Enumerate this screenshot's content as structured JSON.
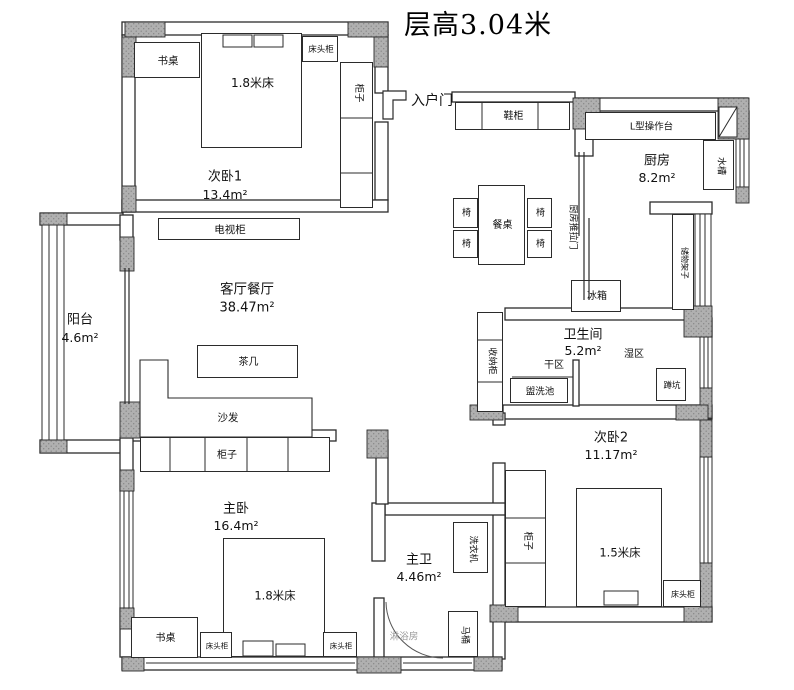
{
  "title": "层高3.04米",
  "rooms": [
    {
      "id": "ciwo1",
      "name": "次卧1",
      "area": "13.4m²"
    },
    {
      "id": "keting",
      "name": "客厅餐厅",
      "area": "38.47m²"
    },
    {
      "id": "yangtai",
      "name": "阳台",
      "area": "4.6m²"
    },
    {
      "id": "chufang",
      "name": "厨房",
      "area": "8.2m²"
    },
    {
      "id": "weishengjian",
      "name": "卫生间",
      "area": "5.2m²"
    },
    {
      "id": "ciwo2",
      "name": "次卧2",
      "area": "11.17m²"
    },
    {
      "id": "zhuwo",
      "name": "主卧",
      "area": "16.4m²"
    },
    {
      "id": "zhuwei",
      "name": "主卫",
      "area": "4.46m²"
    }
  ],
  "furniture": [
    {
      "id": "desk1",
      "label": "书桌"
    },
    {
      "id": "bed1",
      "label": "1.8米床"
    },
    {
      "id": "nightstand1",
      "label": "床头柜"
    },
    {
      "id": "wardrobe1",
      "label": "柜子"
    },
    {
      "id": "tv-cabinet",
      "label": "电视柜"
    },
    {
      "id": "shoe-cabinet",
      "label": "鞋柜"
    },
    {
      "id": "counter",
      "label": "L型操作台"
    },
    {
      "id": "sink",
      "label": "水槽"
    },
    {
      "id": "fridge",
      "label": "冰箱"
    },
    {
      "id": "dining-table",
      "label": "餐桌"
    },
    {
      "id": "chair1",
      "label": "椅"
    },
    {
      "id": "chair2",
      "label": "椅"
    },
    {
      "id": "chair3",
      "label": "椅"
    },
    {
      "id": "chair4",
      "label": "椅"
    },
    {
      "id": "tea-table",
      "label": "茶几"
    },
    {
      "id": "storage-cabinet",
      "label": "收纳柜"
    },
    {
      "id": "washbasin",
      "label": "盥洗池"
    },
    {
      "id": "squat-toilet",
      "label": "蹲坑"
    },
    {
      "id": "wardrobe2",
      "label": "柜子"
    },
    {
      "id": "bed2",
      "label": "1.5米床"
    },
    {
      "id": "nightstand2",
      "label": "床头柜"
    },
    {
      "id": "wardrobe3",
      "label": "柜子"
    },
    {
      "id": "bed3",
      "label": "1.8米床"
    },
    {
      "id": "desk2",
      "label": "书桌"
    },
    {
      "id": "nightstand3",
      "label": "床头柜"
    },
    {
      "id": "nightstand4",
      "label": "床头柜"
    },
    {
      "id": "washer",
      "label": "洗衣机"
    },
    {
      "id": "toilet",
      "label": "马桶"
    },
    {
      "id": "storage-shelf",
      "label": "储物架子"
    }
  ],
  "annotations": [
    {
      "id": "entry-door",
      "label": "入户门"
    },
    {
      "id": "kitchen-sliding-door",
      "label": "厨房推拉门"
    },
    {
      "id": "dry-zone",
      "label": "干区"
    },
    {
      "id": "wet-zone",
      "label": "湿区"
    },
    {
      "id": "sofa",
      "label": "沙发"
    },
    {
      "id": "shower-room",
      "label": "淋浴房"
    }
  ],
  "colors": {
    "wall_line": "#2b2b2b",
    "pillar_fill": "#b0b0b0",
    "text": "#111111"
  }
}
